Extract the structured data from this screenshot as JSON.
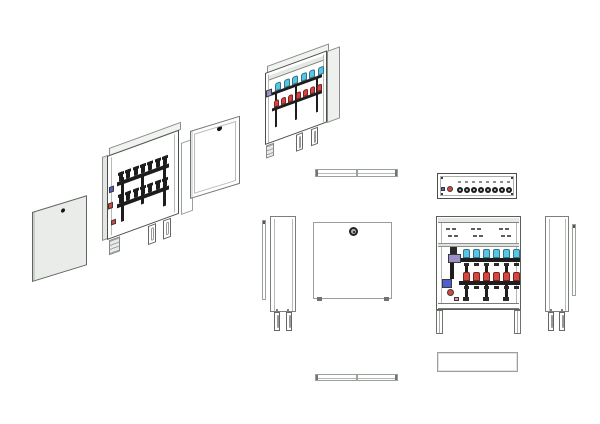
{
  "colors": {
    "background": "#ffffff",
    "panel_gray": "#e9ece9",
    "valve_black": "#1d1d1d",
    "cap_blue": "#58c4e6",
    "cap_red": "#d24840",
    "pump_purple": "#9c8ec9",
    "fitting_blue": "#4a5fd2",
    "fitting_red": "#d24840",
    "fitting_pink": "#e09aa8",
    "edge_gray": "#9aa09a",
    "edge_dark": "#4a4f4a"
  },
  "drawing": {
    "subject": "manifold-cabinet-technical-drawing",
    "views": {
      "iso_exploded": {
        "back_panel": {
          "lock": true
        },
        "open_cabinet": {
          "valves_top": 7,
          "valves_bottom": 7,
          "fittings_left": [
            "blue",
            "red",
            "red"
          ],
          "legs": 2
        },
        "front_door": {
          "lock": true
        }
      },
      "iso_assembled": {
        "blue_caps": 6,
        "red_caps": 7,
        "pump": "purple",
        "legs": 2
      },
      "orthographic": {
        "door_top": {},
        "door_bottom": {},
        "door_side_left": {},
        "door_side_right": {},
        "door_front": {
          "lock": true,
          "feet": 2
        },
        "cabinet_top": {
          "valve_circles": 8,
          "blue_fitting": 1,
          "red_fitting": 1,
          "corner_screws": 4
        },
        "cabinet_front": {
          "slot_groups": 3,
          "slots_per_group": 4,
          "blue_caps": 6,
          "red_caps": 6,
          "pump": "purple",
          "risers": 3,
          "legs": 2
        },
        "cabinet_bottom": {},
        "cabinet_side_left": {
          "legs": 2
        },
        "cabinet_side_right": {
          "legs": 2
        }
      }
    }
  }
}
